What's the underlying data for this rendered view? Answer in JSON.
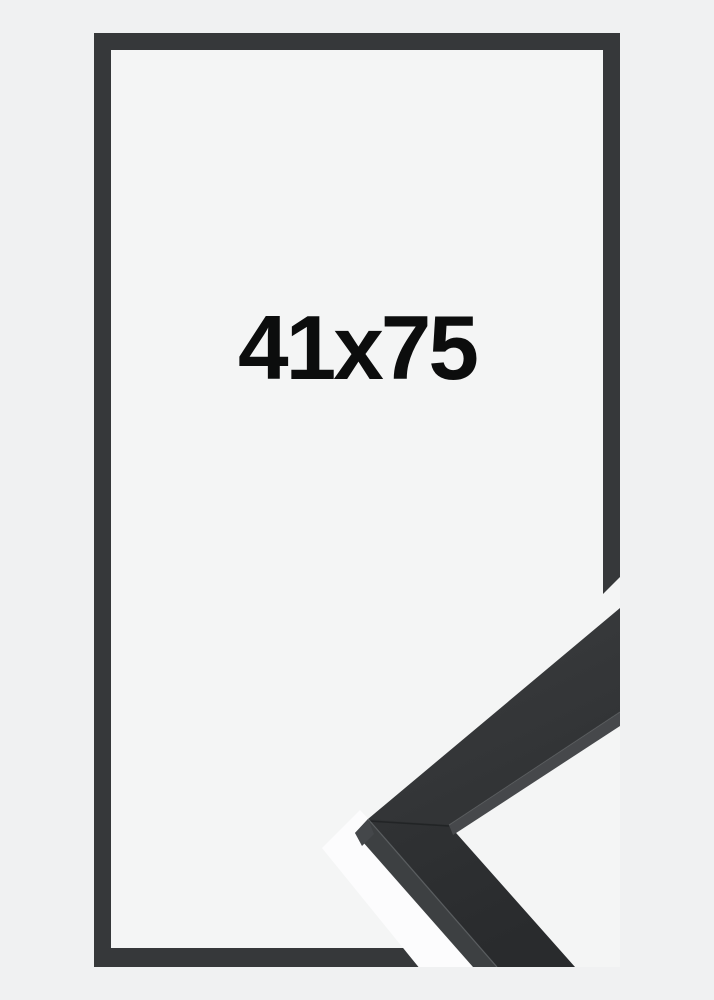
{
  "product": {
    "size_label": "41x75",
    "description": "black picture frame size mockup with corner sample"
  },
  "theme": {
    "page_bg": "#f0f1f2",
    "interior_bg": "#f4f5f5",
    "frame_color": "#36383a",
    "label_color": "#0c0d0d",
    "photo_bg": "#fcfcfd",
    "mould_face_light": "#3b3d3f",
    "mould_face_dark": "#2c2e30",
    "mould_side_inner": "#46484b",
    "mould_side_outer": "#3d4042",
    "mould_facet": "#44474a",
    "mould_highlight": "#5d6063",
    "mould_seam": "#1e2022"
  }
}
